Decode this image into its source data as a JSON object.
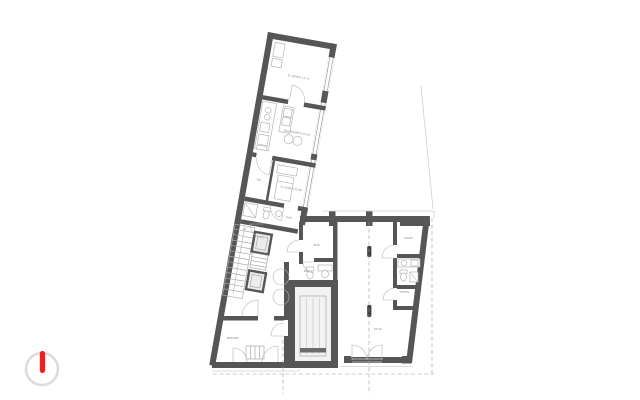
{
  "document": {
    "type": "architectural-floor-plan",
    "background": "#ffffff"
  },
  "colors": {
    "wall-color": "#565656",
    "line-color": "#a9a9a9",
    "furniture-color": "#b5b5b5",
    "dashed-color": "#9b9b9b",
    "label-color": "#8a8a8a",
    "light-color": "#cfcfcf",
    "logo-ring": "#dcdcdc",
    "logo-red": "#e8231f"
  },
  "logo": {
    "icon": "power-circle-icon"
  },
  "plan": {
    "rooms": [
      {
        "label": "SL.KAMER 13.70"
      },
      {
        "label": "WOONKAMER 26.40"
      },
      {
        "label": "HAL"
      },
      {
        "label": "SL.KAMER 09.80"
      },
      {
        "label": "BAD"
      },
      {
        "label": "BUR."
      },
      {
        "label": "WC"
      },
      {
        "label": "BERGING"
      },
      {
        "label": "WASPL."
      },
      {
        "label": "TECHN."
      },
      {
        "label": "86.40"
      }
    ]
  }
}
